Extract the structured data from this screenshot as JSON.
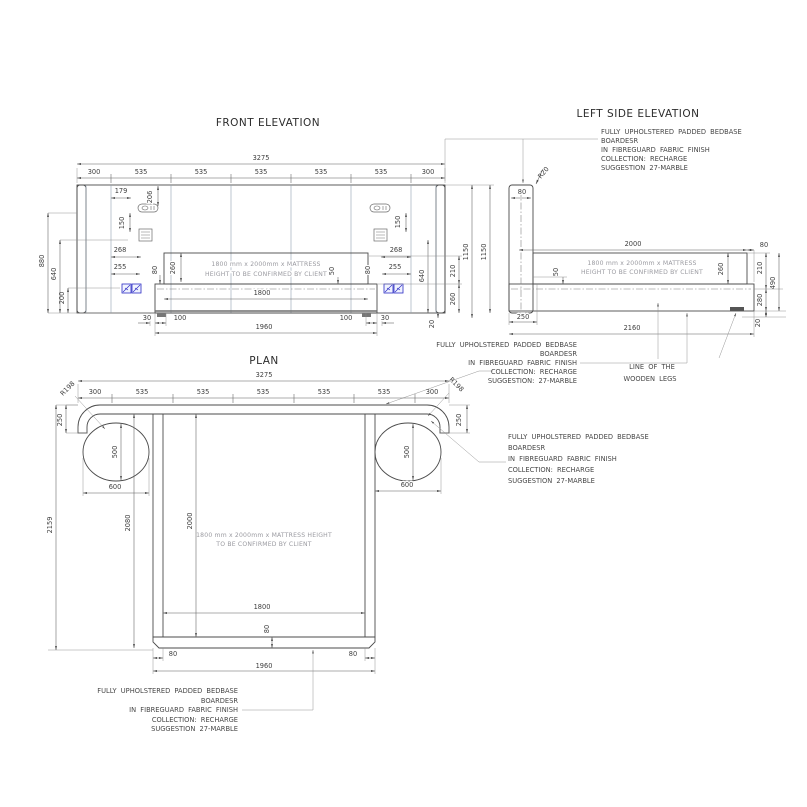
{
  "titles": {
    "front": "FRONT ELEVATION",
    "side": "LEFT SIDE ELEVATION",
    "plan": "PLAN"
  },
  "mattress": {
    "fe1": "1800 mm x 2000mm x MATTRESS",
    "fe2": "HEIGHT TO BE CONFIRMED BY CLIENT",
    "plan1": "1800 mm x 2000mm x MATTRESS HEIGHT",
    "plan2": "TO BE CONFIRMED BY CLIENT"
  },
  "notes": {
    "side": [
      "FULLY UPHOLSTERED PADDED BEDBASE",
      "BOARDESR",
      "IN FIBREGUARD FABRIC FINISH",
      "COLLECTION: RECHARGE",
      "SUGGESTION 27-MARBLE"
    ],
    "base_side": [
      "FULLY UPHOLSTERED PADDED BEDBASE",
      "BOARDESR",
      "IN FIBREGUARD FABRIC FINISH",
      "COLLECTION: RECHARGE",
      "SUGGESTION: 27-MARBLE"
    ],
    "plan_right": [
      "FULLY UPHOLSTERED PADDED BEDBASE",
      "BOARDESR",
      "IN FIBREGUARD FABRIC FINISH",
      "COLLECTION: RECHARGE",
      "SUGGESTION 27-MARBLE"
    ],
    "plan_bottom": [
      "FULLY UPHOLSTERED PADDED BEDBASE",
      "BOARDESR",
      "IN FIBREGUARD FABRIC FINISH",
      "COLLECTION: RECHARGE",
      "SUGGESTION 27-MARBLE"
    ],
    "legs": [
      "LINE OF THE",
      "WOODEN LEGS"
    ]
  },
  "dims": {
    "d3275": "3275",
    "d300": "300",
    "d535": "535",
    "d179": "179",
    "d206": "206",
    "d150": "150",
    "d268": "268",
    "d255": "255",
    "d880": "880",
    "d640": "640",
    "d200": "200",
    "d80": "80",
    "d260": "260",
    "d50": "50",
    "d1800": "1800",
    "d30": "30",
    "d100": "100",
    "d1960": "1960",
    "d1150": "1150",
    "d210": "210",
    "d20": "20",
    "r20": "R20",
    "d2000": "2000",
    "d250": "250",
    "d2160": "2160",
    "d490": "490",
    "d280": "280",
    "d2159": "2159",
    "d2080": "2080",
    "d500": "500",
    "d600": "600",
    "r198": "R198"
  },
  "colors": {
    "hatch_fill": "#e9eef4",
    "hatch_line": "#c2cfdd",
    "line": "#4b4b4b",
    "accent_blue": "#2b2bc4"
  }
}
